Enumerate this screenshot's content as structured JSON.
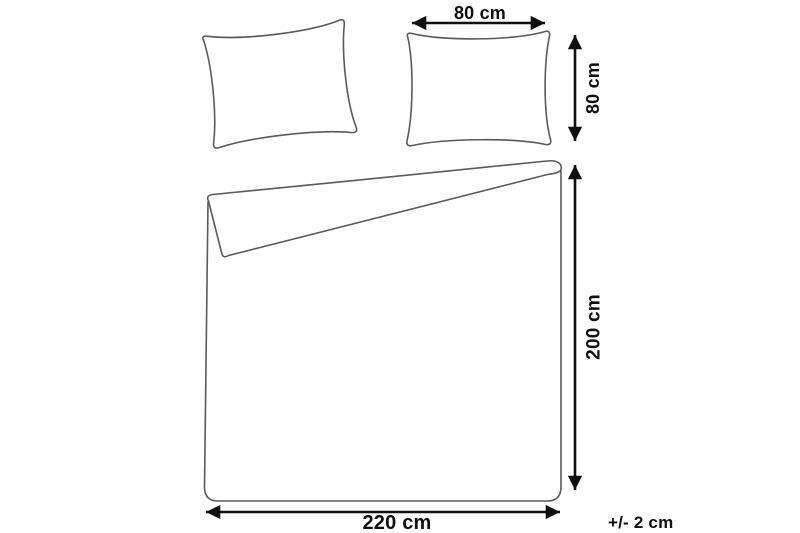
{
  "diagram": {
    "type": "product-dimension-diagram",
    "subject": "bedding-set (duvet cover and two pillowcases)",
    "colors": {
      "background": "#ffffff",
      "outline": "#5a5a5a",
      "dimension": "#0f0f0f"
    },
    "measurements": {
      "pillow_width": {
        "label": "80 cm",
        "value_cm": 80
      },
      "pillow_height": {
        "label": "80 cm",
        "value_cm": 80
      },
      "duvet_height": {
        "label": "200 cm",
        "value_cm": 200
      },
      "duvet_width": {
        "label": "220 cm",
        "value_cm": 220
      },
      "tolerance": {
        "label": "+/- 2 cm"
      }
    }
  }
}
